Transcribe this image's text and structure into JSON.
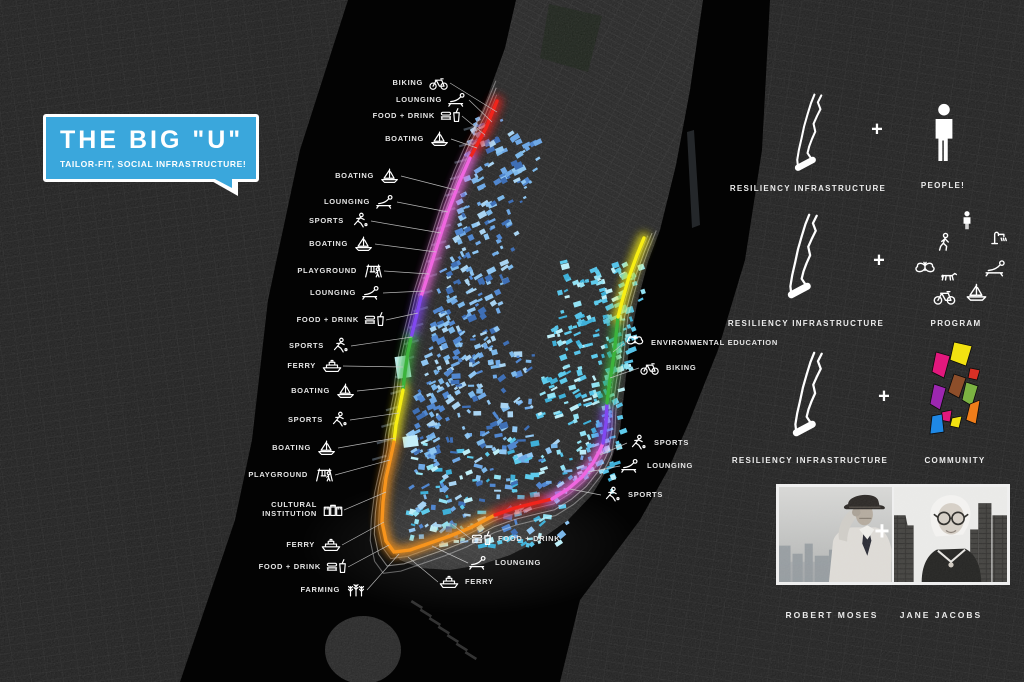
{
  "title": {
    "main": "THE BIG \"U\"",
    "subtitle": "TAILOR-FIT, SOCIAL INFRASTRUCTURE!"
  },
  "plus": "+",
  "colors": {
    "bubble_blue": "#3aa7dc",
    "u_red": "#f1241c",
    "u_pink": "#f066e0",
    "u_purple": "#8148f0",
    "u_green": "#3cb33c",
    "u_yellow": "#f7ee14",
    "u_orange": "#f7941d",
    "building_blues": [
      "#6fa9e6",
      "#8fc6f2",
      "#5187cf",
      "#a9d4f2",
      "#3f6fb5",
      "#5ecbec",
      "#93e2f4",
      "#3fb0d8",
      "#bdeef8"
    ],
    "community_palette": [
      "#f2e211",
      "#e2187d",
      "#d93025",
      "#ef7d1a",
      "#7cb342",
      "#8d4e2a",
      "#9c27b0",
      "#1e88e5"
    ]
  },
  "map_labels": [
    {
      "text": "BIKING",
      "icon": "biking",
      "ax": 437,
      "ay": 83,
      "tx": 497,
      "ty": 112,
      "side": "w"
    },
    {
      "text": "LOUNGING",
      "icon": "lounging",
      "ax": 456,
      "ay": 100,
      "tx": 492,
      "ty": 122,
      "side": "w"
    },
    {
      "text": "FOOD + DRINK",
      "icon": "food-drink",
      "ax": 449,
      "ay": 116,
      "tx": 485,
      "ty": 135,
      "side": "w"
    },
    {
      "text": "BOATING",
      "icon": "boating",
      "ax": 438,
      "ay": 139,
      "tx": 477,
      "ty": 148,
      "side": "w"
    },
    {
      "text": "BOATING",
      "icon": "boating",
      "ax": 388,
      "ay": 176,
      "tx": 456,
      "ty": 190,
      "side": "w"
    },
    {
      "text": "LOUNGING",
      "icon": "lounging",
      "ax": 384,
      "ay": 202,
      "tx": 448,
      "ty": 212,
      "side": "w"
    },
    {
      "text": "SPORTS",
      "icon": "sports",
      "ax": 358,
      "ay": 221,
      "tx": 441,
      "ty": 233,
      "side": "w"
    },
    {
      "text": "BOATING",
      "icon": "boating",
      "ax": 362,
      "ay": 244,
      "tx": 436,
      "ty": 252,
      "side": "w"
    },
    {
      "text": "PLAYGROUND",
      "icon": "playground",
      "ax": 371,
      "ay": 271,
      "tx": 429,
      "ty": 274,
      "side": "w"
    },
    {
      "text": "LOUNGING",
      "icon": "lounging",
      "ax": 370,
      "ay": 293,
      "tx": 424,
      "ty": 291,
      "side": "w"
    },
    {
      "text": "FOOD + DRINK",
      "icon": "food-drink",
      "ax": 373,
      "ay": 320,
      "tx": 418,
      "ty": 313,
      "side": "w"
    },
    {
      "text": "SPORTS",
      "icon": "sports",
      "ax": 338,
      "ay": 346,
      "tx": 412,
      "ty": 337,
      "side": "w"
    },
    {
      "text": "FERRY",
      "icon": "ferry",
      "ax": 330,
      "ay": 366,
      "tx": 403,
      "ty": 367,
      "side": "w"
    },
    {
      "text": "BOATING",
      "icon": "boating",
      "ax": 344,
      "ay": 391,
      "tx": 404,
      "ty": 386,
      "side": "w"
    },
    {
      "text": "SPORTS",
      "icon": "sports",
      "ax": 337,
      "ay": 420,
      "tx": 399,
      "ty": 413,
      "side": "w"
    },
    {
      "text": "BOATING",
      "icon": "boating",
      "ax": 325,
      "ay": 448,
      "tx": 395,
      "ty": 438,
      "side": "w"
    },
    {
      "text": "PLAYGROUND",
      "icon": "playground",
      "ax": 322,
      "ay": 475,
      "tx": 390,
      "ty": 460,
      "side": "w"
    },
    {
      "text": "CULTURAL INSTITUTION",
      "icon": "cultural",
      "ax": 331,
      "ay": 510,
      "tx": 386,
      "ty": 492,
      "side": "w",
      "two": 1
    },
    {
      "text": "FERRY",
      "icon": "ferry",
      "ax": 329,
      "ay": 545,
      "tx": 384,
      "ty": 522,
      "side": "w"
    },
    {
      "text": "FOOD + DRINK",
      "icon": "food-drink",
      "ax": 335,
      "ay": 567,
      "tx": 389,
      "ty": 545,
      "side": "w"
    },
    {
      "text": "FARMING",
      "icon": "farming",
      "ax": 354,
      "ay": 590,
      "tx": 399,
      "ty": 554,
      "side": "w"
    },
    {
      "text": "FOOD + DRINK",
      "icon": "food-drink",
      "ax": 484,
      "ay": 539,
      "tx": 452,
      "ty": 524,
      "side": "e"
    },
    {
      "text": "LOUNGING",
      "icon": "lounging",
      "ax": 481,
      "ay": 563,
      "tx": 432,
      "ty": 546,
      "side": "e"
    },
    {
      "text": "FERRY",
      "icon": "ferry",
      "ax": 451,
      "ay": 582,
      "tx": 408,
      "ty": 557,
      "side": "e"
    },
    {
      "text": "ENVIRONMENTAL EDUCATION",
      "icon": "butterfly",
      "ax": 637,
      "ay": 343,
      "tx": 613,
      "ty": 352,
      "side": "e"
    },
    {
      "text": "BIKING",
      "icon": "biking",
      "ax": 652,
      "ay": 368,
      "tx": 610,
      "ty": 378,
      "side": "e"
    },
    {
      "text": "SPORTS",
      "icon": "sports",
      "ax": 640,
      "ay": 443,
      "tx": 600,
      "ty": 455,
      "side": "e"
    },
    {
      "text": "LOUNGING",
      "icon": "lounging",
      "ax": 633,
      "ay": 466,
      "tx": 588,
      "ty": 472,
      "side": "e"
    },
    {
      "text": "SPORTS",
      "icon": "sports",
      "ax": 614,
      "ay": 495,
      "tx": 570,
      "ty": 489,
      "side": "e"
    }
  ],
  "legend": {
    "rows": [
      {
        "left": "RESILIENCY INFRASTRUCTURE",
        "right": "PEOPLE!"
      },
      {
        "left": "RESILIENCY INFRASTRUCTURE",
        "right": "PROGRAM",
        "icons": [
          "person",
          "walking",
          "water-pump",
          "butterfly",
          "dog",
          "lounging",
          "biking",
          "boating"
        ]
      },
      {
        "left": "RESILIENCY INFRASTRUCTURE",
        "right": "COMMUNITY"
      }
    ]
  },
  "people": [
    {
      "name": "ROBERT MOSES"
    },
    {
      "name": "JANE JACOBS"
    }
  ]
}
